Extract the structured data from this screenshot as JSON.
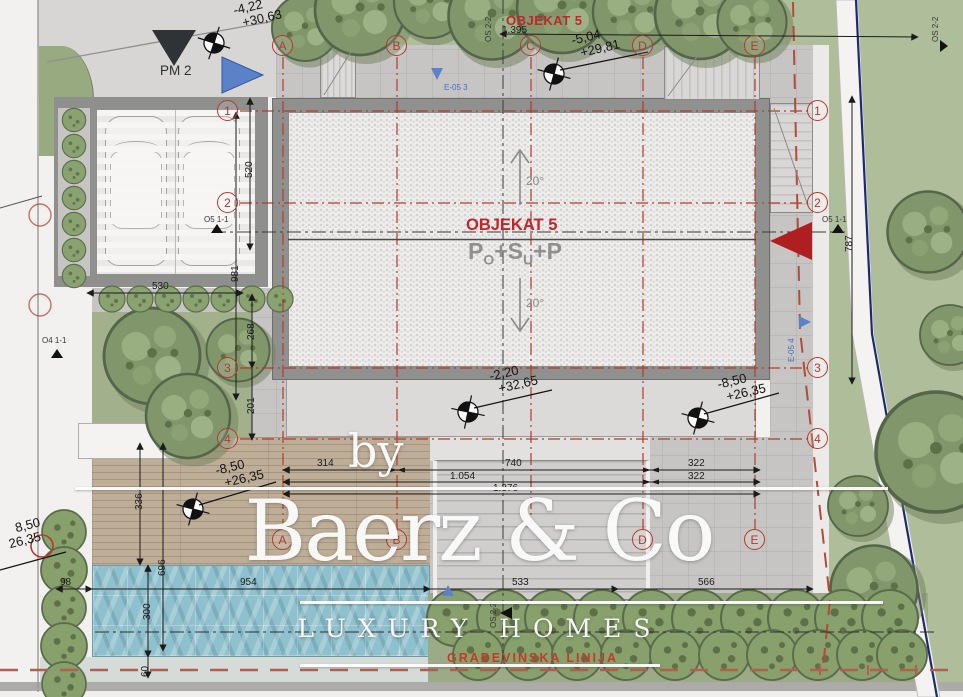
{
  "watermark": {
    "by": "by",
    "brand": "Baerz & Co",
    "tagline": "LUXURY HOMES"
  },
  "building": {
    "top_name": "OBJEKAT 5",
    "name": "OBJEKAT 5",
    "f1": "P",
    "f1s": "O",
    "f2": "+S",
    "f2s": "U",
    "f3": "+P",
    "slope_up": "20°",
    "slope_down": "20°"
  },
  "labels": {
    "pm2": "PM 2",
    "o5_section": "O5 1-1",
    "o4_section": "O4 1-1",
    "os_section": "OS 2-2",
    "e05_3": "E-05 3",
    "e05_4": "E-05 4",
    "building_line": "GRAĐEVINSKA LINIJA"
  },
  "elevations": {
    "nw": {
      "a": "-4,22",
      "b": "+30,63"
    },
    "north": {
      "a": "-5,04",
      "b": "+29,81"
    },
    "terrace": {
      "a": "-2,20",
      "b": "+32,65"
    },
    "deck": {
      "a": "-8,50",
      "b": "+26,35"
    },
    "plaza": {
      "a": "-8,50",
      "b": "+26,35"
    },
    "sw": {
      "a": "8,50",
      "b": "26,35"
    }
  },
  "dims": {
    "total_top": "1.395",
    "garage_w": "530",
    "garage_d": "520",
    "left_981": "981",
    "left_268": "268",
    "left_201": "201",
    "a_b": "314",
    "b_d": "740",
    "a_d": "1.054",
    "a_e": "1.376",
    "d_e_1": "322",
    "d_e_2": "322",
    "deck_h": "336",
    "deck_pool": "696",
    "pool_off": "98",
    "pool_w": "954",
    "pool_h": "300",
    "channel": "60",
    "stairs_w": "533",
    "plaza_w": "566",
    "right_h": "787"
  },
  "grid": {
    "cols": [
      "A",
      "B",
      "C",
      "D",
      "E"
    ],
    "rows": [
      "1",
      "2",
      "3",
      "4"
    ]
  },
  "colors": {
    "grid_red": "#b33a2c",
    "accent_red": "#c0272d",
    "marker_blue": "#5b82c8",
    "path_navy": "#1c2a6e",
    "water": "#8fc0cd"
  }
}
